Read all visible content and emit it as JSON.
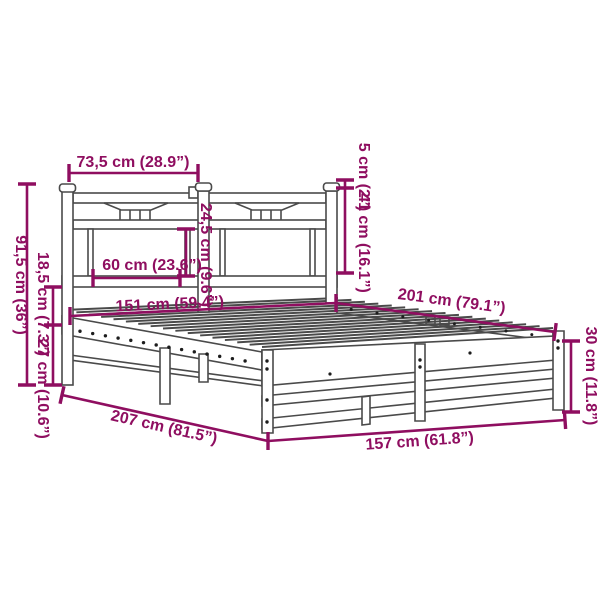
{
  "diagram": {
    "type": "product-dimension-diagram",
    "subject": "metal bed frame with headboard",
    "background": "#ffffff",
    "accent_color": "#8f0e60",
    "line_color": "#4a4a4a",
    "dimensions": {
      "headboard_section_width": "73,5 cm (28.9”)",
      "post_top_height": "5 cm (2”)",
      "headboard_panel_height": "41 cm (16.1”)",
      "opening_width": "60 cm (23.6”)",
      "opening_height": "24,5 cm (9.6”)",
      "slat_length": "151 cm (59.4”)",
      "bed_length": "201 cm (79.1”)",
      "foot_end_height": "30 cm (11.8”)",
      "headboard_total_height": "91,5 cm (36”)",
      "rail_to_slat_height": "18,5 cm (7.3”)",
      "under_bed_clearance": "27 cm (10.6”)",
      "total_length": "207 cm (81.5”)",
      "total_width": "157 cm (61.8”)"
    }
  }
}
